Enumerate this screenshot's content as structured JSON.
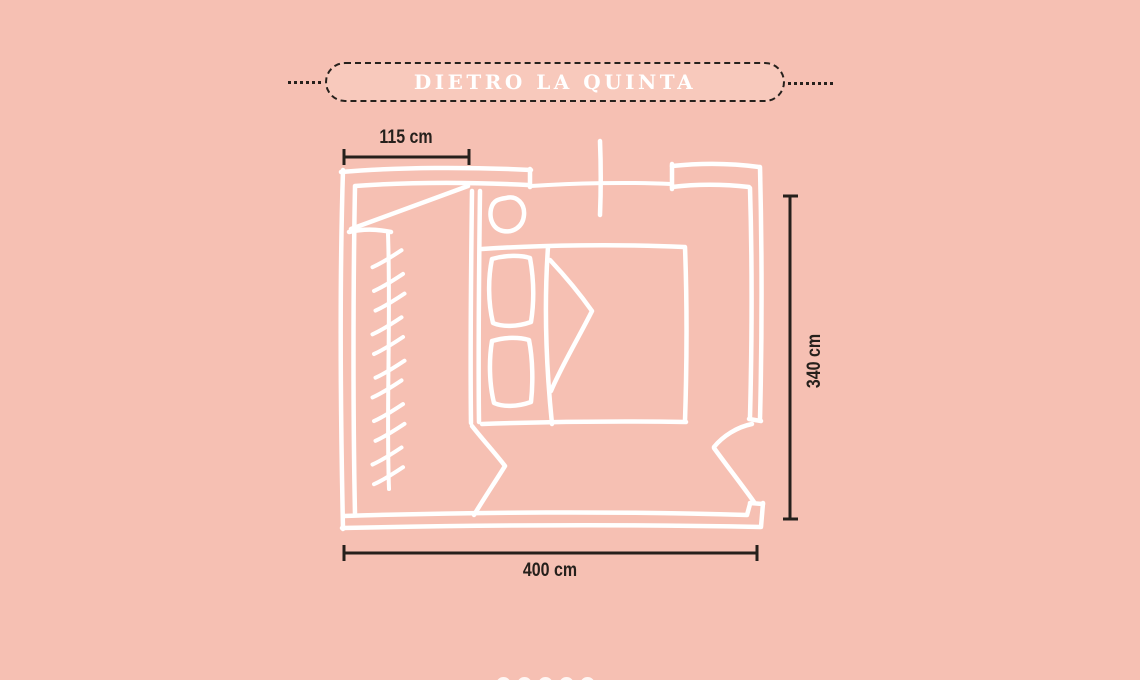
{
  "colors": {
    "background": "#f6c0b3",
    "banner_fill": "#f8c9bc",
    "ink": "#26201c",
    "line_white": "#ffffff"
  },
  "banner": {
    "title": "DIETRO LA QUINTA"
  },
  "dimensions": {
    "items": [
      {
        "id": "wardrobe-width",
        "label": "115 cm",
        "value": 115,
        "unit": "cm",
        "orientation": "horizontal"
      },
      {
        "id": "room-depth",
        "label": "340 cm",
        "value": 340,
        "unit": "cm",
        "orientation": "vertical"
      },
      {
        "id": "room-width",
        "label": "400 cm",
        "value": 400,
        "unit": "cm",
        "orientation": "horizontal"
      }
    ]
  },
  "floor_plan": {
    "type": "bedroom-sketch",
    "features": [
      "outer-walls",
      "window-top",
      "window-center-mark",
      "partition-quinta",
      "wardrobe-hanger-rail",
      "hanger-marks",
      "stool",
      "double-bed",
      "pillows",
      "folded-blanket",
      "curtain-mark",
      "door-bottom-right"
    ],
    "hanger_marks_count": 11,
    "pillow_count": 2
  },
  "decor": {
    "bottom_dots_count": 5
  }
}
